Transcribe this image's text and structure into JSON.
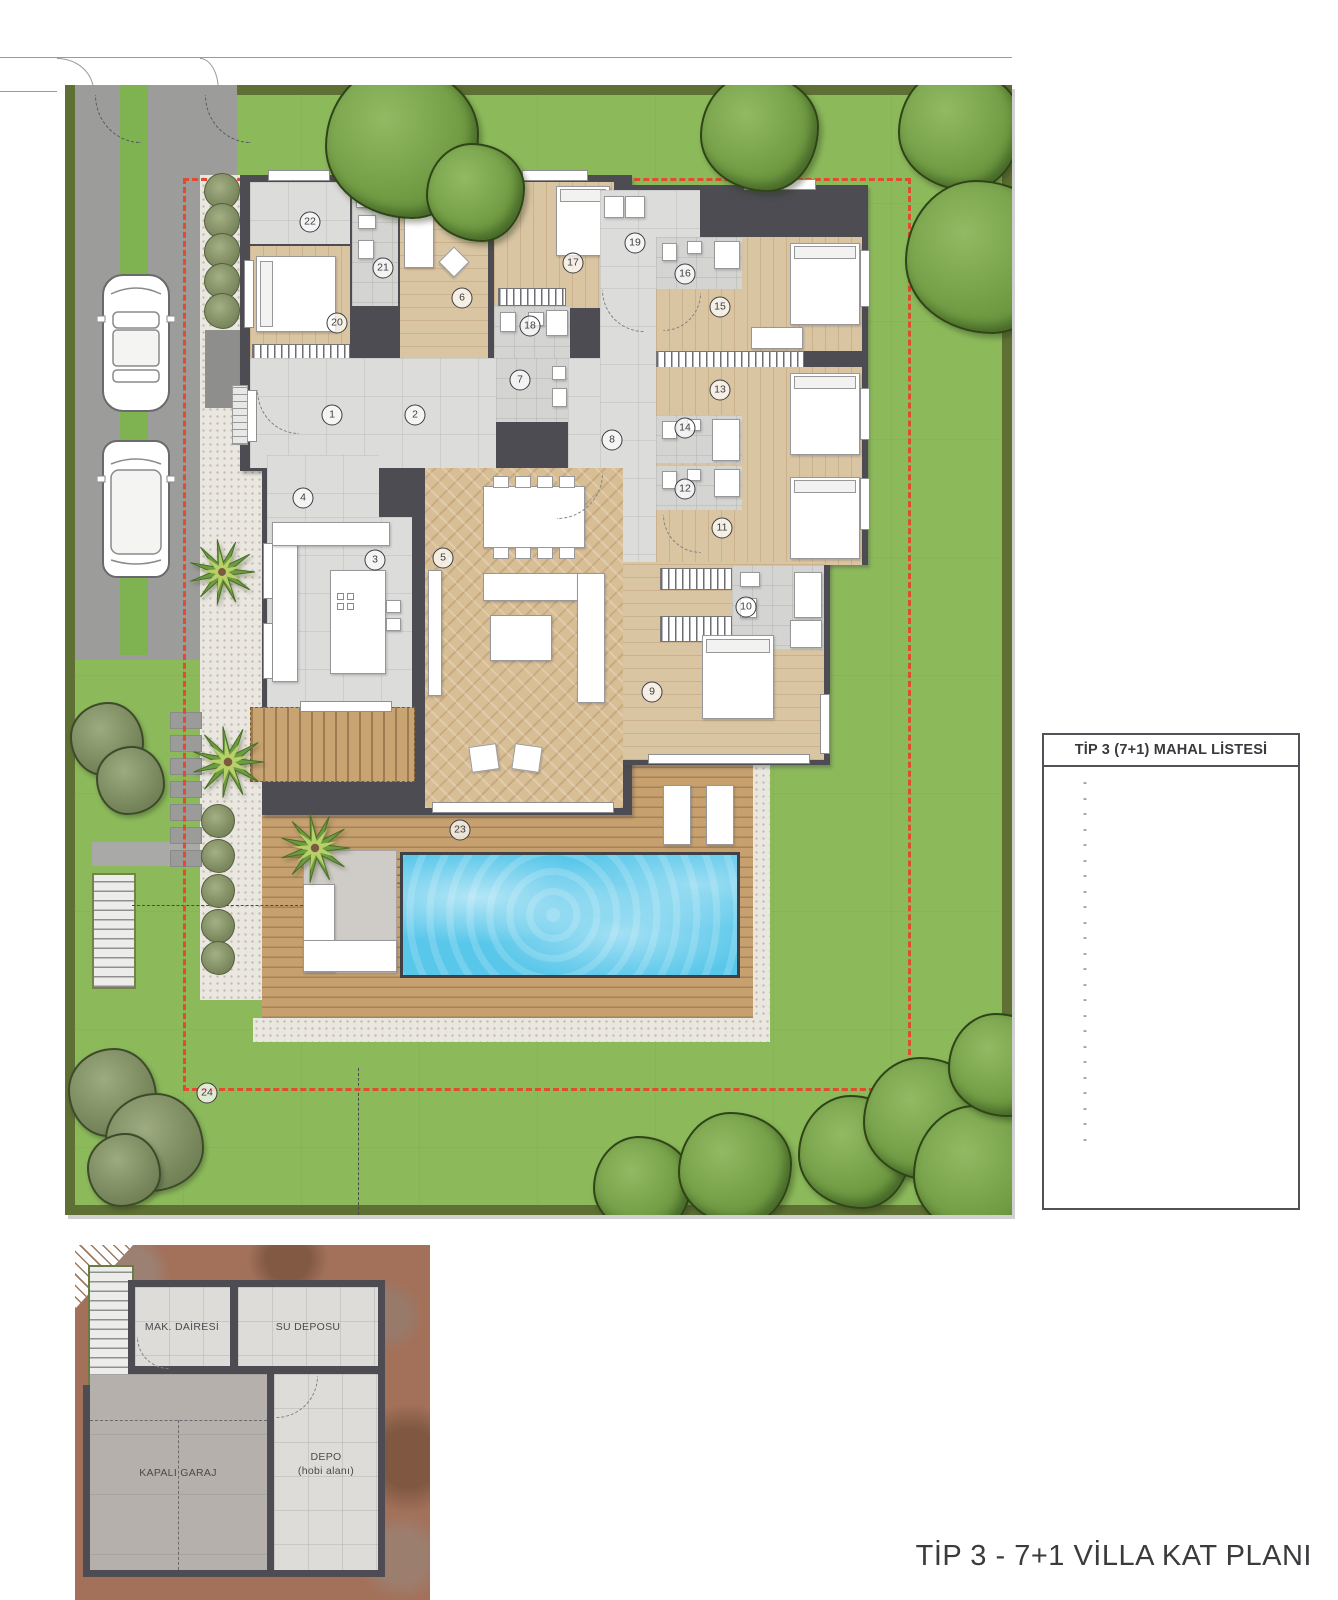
{
  "title": "TİP 3 - 7+1 VİLLA KAT PLANI",
  "legend": {
    "title": "TİP 3 (7+1) MAHAL LİSTESİ",
    "rows": [
      {
        "no": "1",
        "name": "GİRİŞ HOLÜ",
        "area": "5,80 m²"
      },
      {
        "no": "2",
        "name": "HOL",
        "area": "12,30 m²"
      },
      {
        "no": "3",
        "name": "MUTFAK",
        "area": "26,30 m²"
      },
      {
        "no": "4",
        "name": "KİLER",
        "area": "4,00 m²"
      },
      {
        "no": "5",
        "name": "SALON",
        "area": "53,00 m²"
      },
      {
        "no": "6",
        "name": "ÇALIŞMA ODASI",
        "area": "13,50 m²"
      },
      {
        "no": "7",
        "name": "W.C.",
        "area": "5,00 m²"
      },
      {
        "no": "8",
        "name": "KORİDOR",
        "area": "15,70 m²"
      },
      {
        "no": "9",
        "name": "EBV. YATAK ODASI",
        "area": "30,60 m²"
      },
      {
        "no": "10",
        "name": "EBV. BANYO",
        "area": "6,00 m²"
      },
      {
        "no": "11",
        "name": "YATAK ODASI 1",
        "area": "15,50 m²"
      },
      {
        "no": "12",
        "name": "BANYO 1",
        "area": "3,10 m²"
      },
      {
        "no": "13",
        "name": "YATAK ODASI 2",
        "area": "15,50 m²"
      },
      {
        "no": "14",
        "name": "BANYO 2",
        "area": "3,10 m²"
      },
      {
        "no": "15",
        "name": "YATAK ODASI 3",
        "area": "15,50 m²"
      },
      {
        "no": "16",
        "name": "BANYO 3",
        "area": "3,10 m²"
      },
      {
        "no": "17",
        "name": "YATAK ODASI 4",
        "area": "13,60 m²"
      },
      {
        "no": "18",
        "name": "BANYO 4",
        "area": "3,10 m²"
      },
      {
        "no": "19",
        "name": "ÇAMAŞIR ODASI",
        "area": "6,10 m²"
      },
      {
        "no": "20",
        "name": "YATAK ODASI 5",
        "area": "11,40 m²"
      },
      {
        "no": "21",
        "name": "BANYO 5",
        "area": "3,50 m²"
      },
      {
        "no": "22",
        "name": "TEKNİK ODA",
        "area": "6,80 m²"
      },
      {
        "no": "23",
        "name": "TERAS",
        "area": "47,60 m²"
      },
      {
        "no": "24",
        "name": "ALT KOT GARAJ+DEPO",
        "area": "68,30 m²"
      }
    ],
    "totals": [
      {
        "label": "NET ALAN :",
        "value": "388,40 m²",
        "bold": true
      },
      {
        "label": "HAVUZ :",
        "value": "33,00 m²",
        "bold": false
      },
      {
        "label": "LOCA :",
        "value": "8,00 m²",
        "bold": false
      },
      {
        "label": "GENEL BRÜT ALAN :",
        "value": "503,00 m²",
        "bold": true
      }
    ]
  },
  "notes": [
    {
      "label": "Net Arsa Aralığı :",
      "value": "820  -  1880 m²"
    },
    {
      "label": "Brüt Arsa Aralığı :",
      "value": "1170  -  2680 m²"
    }
  ],
  "plan": {
    "room_markers": [
      "1",
      "2",
      "3",
      "4",
      "5",
      "6",
      "7",
      "8",
      "9",
      "10",
      "11",
      "12",
      "13",
      "14",
      "15",
      "16",
      "17",
      "18",
      "19",
      "20",
      "21",
      "22",
      "23",
      "24"
    ]
  },
  "basement": {
    "rooms": [
      {
        "label": "MAK. DAİRESİ"
      },
      {
        "label": "SU DEPOSU"
      },
      {
        "label": "KAPALI GARAJ"
      },
      {
        "label": "DEPO",
        "sublabel": "(hobi alanı)"
      }
    ]
  },
  "colors": {
    "grass": "#8CBA5B",
    "hedge": "#5E7033",
    "boundary_red": "#E14B2F",
    "wall": "#4C4C52",
    "pool": "#59C7EA",
    "deck_wood": "#C7A06F",
    "earth": "#A3715A"
  }
}
